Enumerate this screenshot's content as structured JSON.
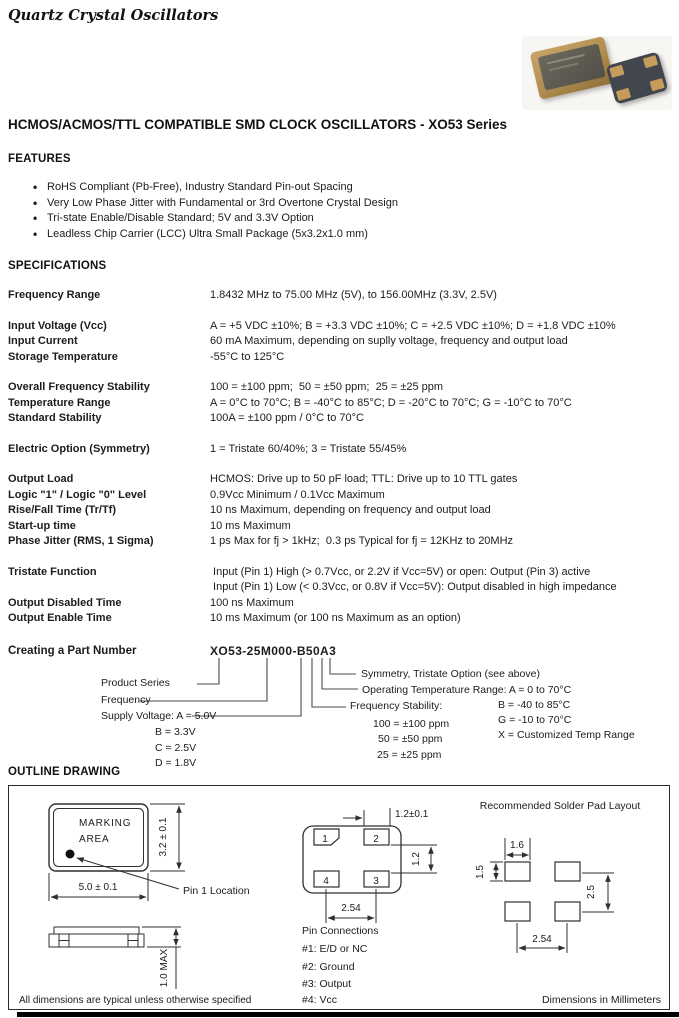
{
  "header": {
    "brand": "Quartz Crystal Oscillators",
    "title": "HCMOS/ACMOS/TTL COMPATIBLE SMD CLOCK OSCILLATORS - XO53 Series"
  },
  "features": {
    "heading": "FEATURES",
    "items": [
      "RoHS Compliant (Pb-Free), Industry Standard Pin-out Spacing",
      "Very Low Phase Jitter with Fundamental or 3rd Overtone Crystal Design",
      "Tri-state Enable/Disable Standard;  5V and 3.3V Option",
      "Leadless Chip Carrier (LCC) Ultra Small Package (5x3.2x1.0 mm)"
    ]
  },
  "specs": {
    "heading": "SPECIFICATIONS",
    "rows": [
      {
        "label": "Frequency Range",
        "value": "1.8432 MHz to 75.00 MHz (5V), to 156.00MHz (3.3V, 2.5V)"
      },
      {
        "label": "Input Voltage (Vcc)",
        "value": "A = +5 VDC ±10%; B = +3.3 VDC ±10%; C = +2.5 VDC ±10%; D = +1.8 VDC ±10%"
      },
      {
        "label": "Input Current",
        "value": "60 mA Maximum, depending on suplly voltage, frequency and output load"
      },
      {
        "label": "Storage Temperature",
        "value": "-55°C to 125°C"
      },
      {
        "label": "Overall Frequency Stability",
        "value": "100 = ±100 ppm;  50 = ±50 ppm;  25 = ±25 ppm"
      },
      {
        "label": "Temperature Range",
        "value": "A = 0°C to 70°C; B = -40°C to 85°C; D = -20°C to 70°C; G = -10°C to 70°C"
      },
      {
        "label": "Standard Stability",
        "value": "100A = ±100 ppm / 0°C to 70°C"
      },
      {
        "label": "Electric Option (Symmetry)",
        "value": "1 = Tristate 60/40%; 3 = Tristate 55/45%"
      },
      {
        "label": "Output Load",
        "value": "HCMOS: Drive up to 50 pF load; TTL: Drive up to 10 TTL gates"
      },
      {
        "label": "Logic \"1\" / Logic \"0\" Level",
        "value": "0.9Vcc Minimum / 0.1Vcc Maximum"
      },
      {
        "label": "Rise/Fall Time (Tr/Tf)",
        "value": "10 ns Maximum, depending on frequency and output load"
      },
      {
        "label": "Start-up time",
        "value": "10 ms Maximum"
      },
      {
        "label": "Phase Jitter (RMS, 1 Sigma)",
        "value": "1 ps Max for fj > 1kHz;  0.3 ps Typical for fj = 12KHz to 20MHz"
      },
      {
        "label": "Tristate Function",
        "value": " Input (Pin 1) High (> 0.7Vcc, or 2.2V if Vcc=5V) or open: Output (Pin 3) active"
      },
      {
        "label": "",
        "value": " Input (Pin 1) Low (< 0.3Vcc, or 0.8V if Vcc=5V): Output disabled in high impedance"
      },
      {
        "label": "Output Disabled Time",
        "value": "100 ns Maximum"
      },
      {
        "label": "Output Enable Time",
        "value": "10 ms Maximum (or 100 ns Maximum as an option)"
      }
    ]
  },
  "part_number": {
    "heading": "Creating a Part Number",
    "example": "XO53-25M000-B50A3",
    "labels": {
      "product_series": "Product Series",
      "frequency": "Frequency",
      "supply_voltage": "Supply Voltage: A = 5.0V",
      "supply_b": "B = 3.3V",
      "supply_c": "C = 2.5V",
      "supply_d": "D = 1.8V",
      "symmetry": "Symmetry, Tristate Option (see above)",
      "op_temp": "Operating Temperature Range: A = 0 to 70°C",
      "temp_b": "B = -40 to 85°C",
      "temp_g": "G = -10 to 70°C",
      "temp_x": "X = Customized Temp Range",
      "stability": "Frequency Stability:",
      "stab_100": "100 = ±100 ppm",
      "stab_50": "50 = ±50 ppm",
      "stab_25": "25 = ±25 ppm"
    }
  },
  "outline": {
    "heading": "OUTLINE DRAWING",
    "marking_line1": "MARKING",
    "marking_line2": "AREA",
    "dim_width": "5.0 ± 0.1",
    "dim_height": "3.2 ± 0.1",
    "dim_thickness": "1.0 MAX",
    "pin1_label": "Pin 1 Location",
    "note": "All dimensions are typical unless otherwise specified",
    "pin_numbers": {
      "p1": "1",
      "p2": "2",
      "p3": "3",
      "p4": "4"
    },
    "dim_pad_width": "1.2±0.1",
    "dim_pad_gap": "1.2",
    "dim_pitch": "2.54",
    "pin_connections": {
      "heading": "Pin Connections",
      "items": [
        "#1: E/D or NC",
        "#2: Ground",
        "#3: Output",
        "#4: Vcc"
      ]
    },
    "solder": {
      "title": "Recommended Solder Pad Layout",
      "dim_pad_w": "1.6",
      "dim_pad_h": "1.5",
      "dim_v_pitch": "2.5",
      "dim_h_pitch": "2.54",
      "footer": "Dimensions in Millimeters"
    }
  }
}
